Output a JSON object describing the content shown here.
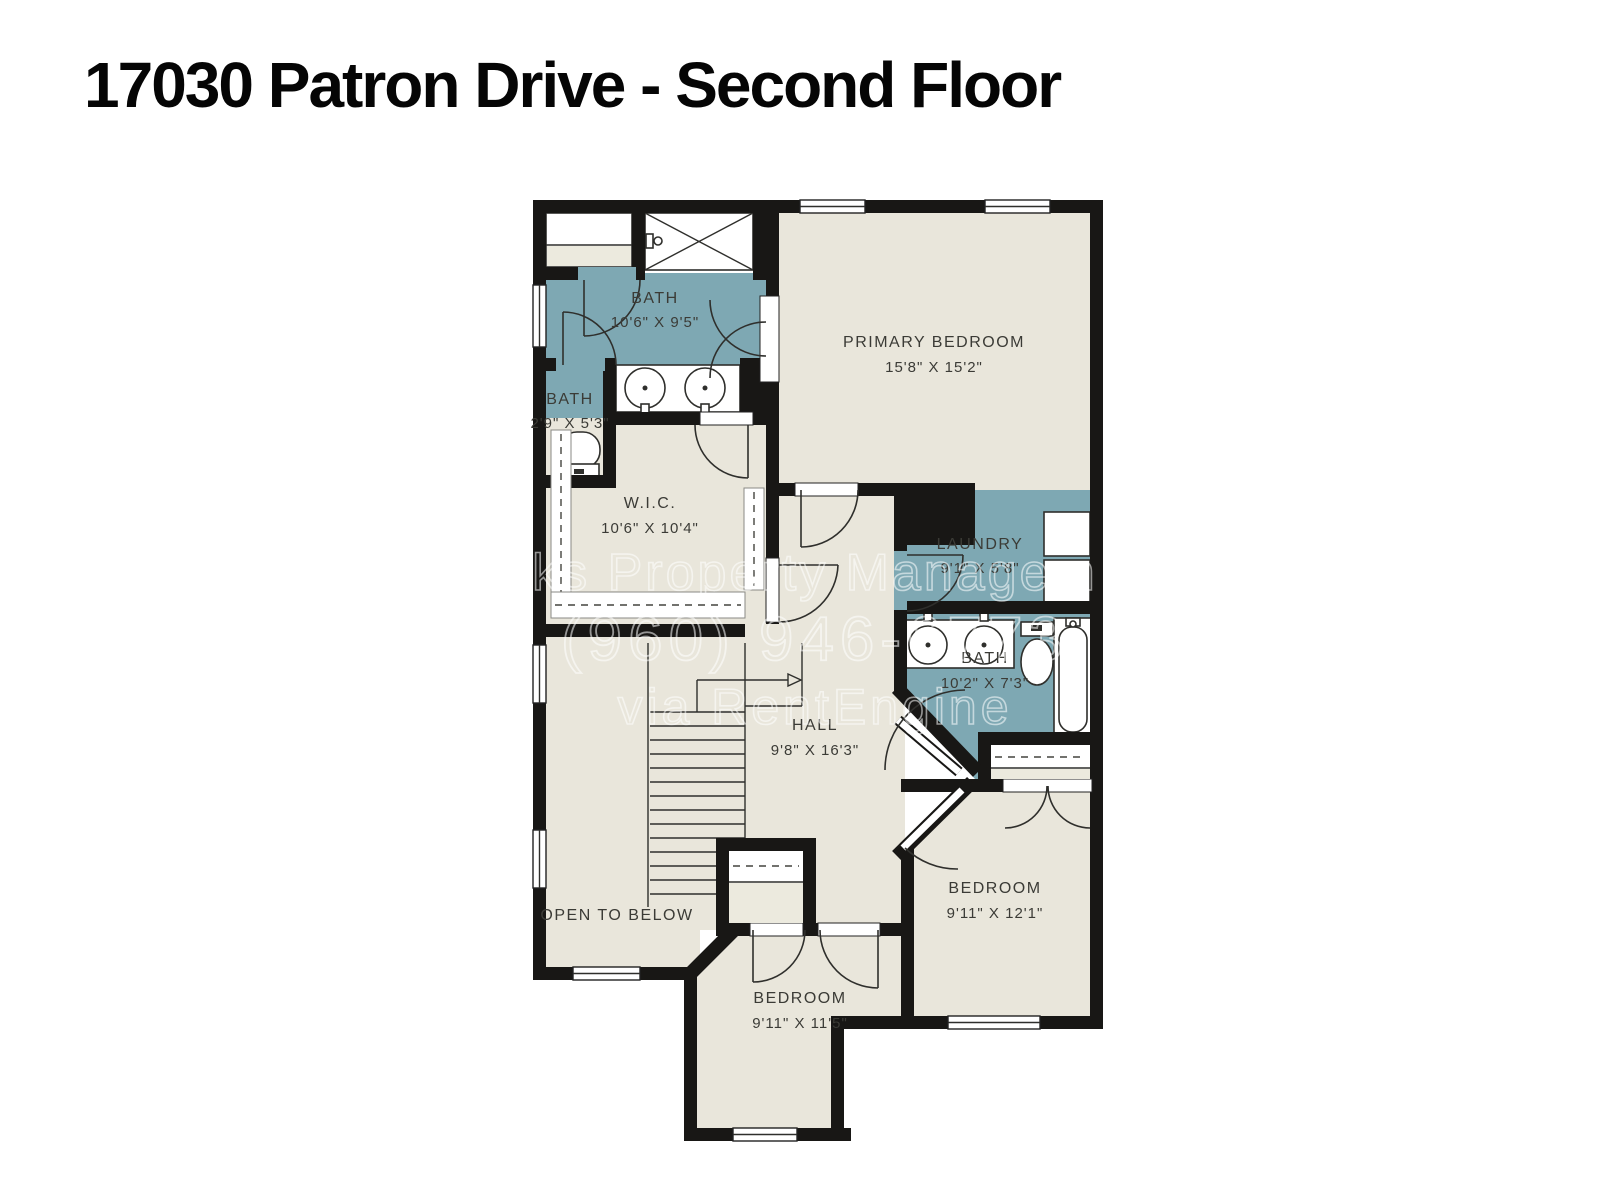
{
  "title": "17030 Patron Drive - Second Floor",
  "watermark": {
    "line1": "ks Property Managem",
    "line2": "(960) 946-6773",
    "line3": "via RentEngine"
  },
  "colors": {
    "wet_room": "#7ea8b3",
    "floor": "#e9e6db",
    "wall": "#181715",
    "page": "#ffffff"
  },
  "rooms": {
    "bath_primary": {
      "label": "BATH",
      "dims": "10'6\" X 9'5\""
    },
    "bath_small": {
      "label": "BATH",
      "dims": "2'9\" X 5'3\""
    },
    "primary_bedroom": {
      "label": "PRIMARY BEDROOM",
      "dims": "15'8\" X 15'2\""
    },
    "wic": {
      "label": "W.I.C.",
      "dims": "10'6\" X 10'4\""
    },
    "laundry": {
      "label": "LAUNDRY",
      "dims": "9'1\" X 5'8\""
    },
    "bath_hall": {
      "label": "BATH",
      "dims": "10'2\" X 7'3\""
    },
    "hall": {
      "label": "HALL",
      "dims": "9'8\" X 16'3\""
    },
    "open_to_below": {
      "label": "OPEN TO BELOW"
    },
    "bedroom_left": {
      "label": "BEDROOM",
      "dims": "9'11\" X 11'5\""
    },
    "bedroom_right": {
      "label": "BEDROOM",
      "dims": "9'11\" X 12'1\""
    }
  }
}
